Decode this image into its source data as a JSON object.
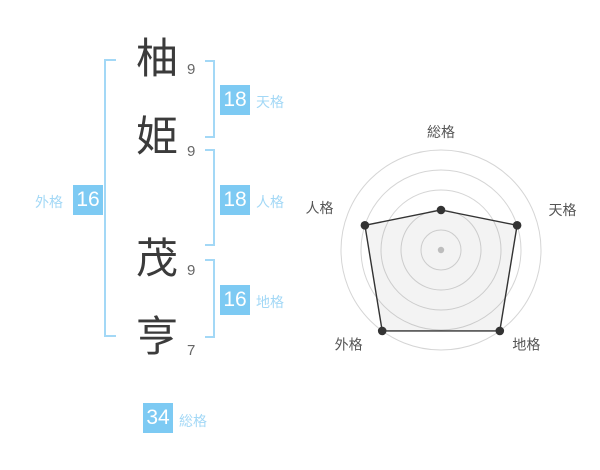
{
  "colors": {
    "accent_blue": "#7dcaf3",
    "light_blue": "#a3d8f6",
    "ink": "#3b3b3b",
    "stroke_number": "#666666",
    "chart_label": "#555555",
    "grid_ring": "#d5d5d5",
    "polygon_line": "#333333",
    "polygon_fill": "rgba(120,120,120,0.09)",
    "center_dot": "#bdbdbd",
    "background": "#ffffff"
  },
  "name": {
    "characters": [
      {
        "char": "柚",
        "strokes": "9",
        "group": "surname"
      },
      {
        "char": "姫",
        "strokes": "9",
        "group": "surname"
      },
      {
        "char": "茂",
        "strokes": "9",
        "group": "given"
      },
      {
        "char": "亨",
        "strokes": "7",
        "group": "given"
      }
    ]
  },
  "kaku": {
    "tenkaku": {
      "value": "18",
      "label": "天格"
    },
    "jinkaku": {
      "value": "18",
      "label": "人格"
    },
    "chikaku": {
      "value": "16",
      "label": "地格"
    },
    "gaikaku": {
      "value": "16",
      "label": "外格"
    },
    "soukaku": {
      "value": "34",
      "label": "総格"
    }
  },
  "chart_data": {
    "type": "radar",
    "title": "",
    "axes": [
      "総格",
      "天格",
      "地格",
      "外格",
      "人格"
    ],
    "values_percent": [
      40,
      80,
      100,
      100,
      80
    ],
    "max": 100,
    "ring_levels": [
      20,
      40,
      60,
      80,
      100
    ],
    "grid": "concentric-circles",
    "spokes": false,
    "legend": "none"
  }
}
